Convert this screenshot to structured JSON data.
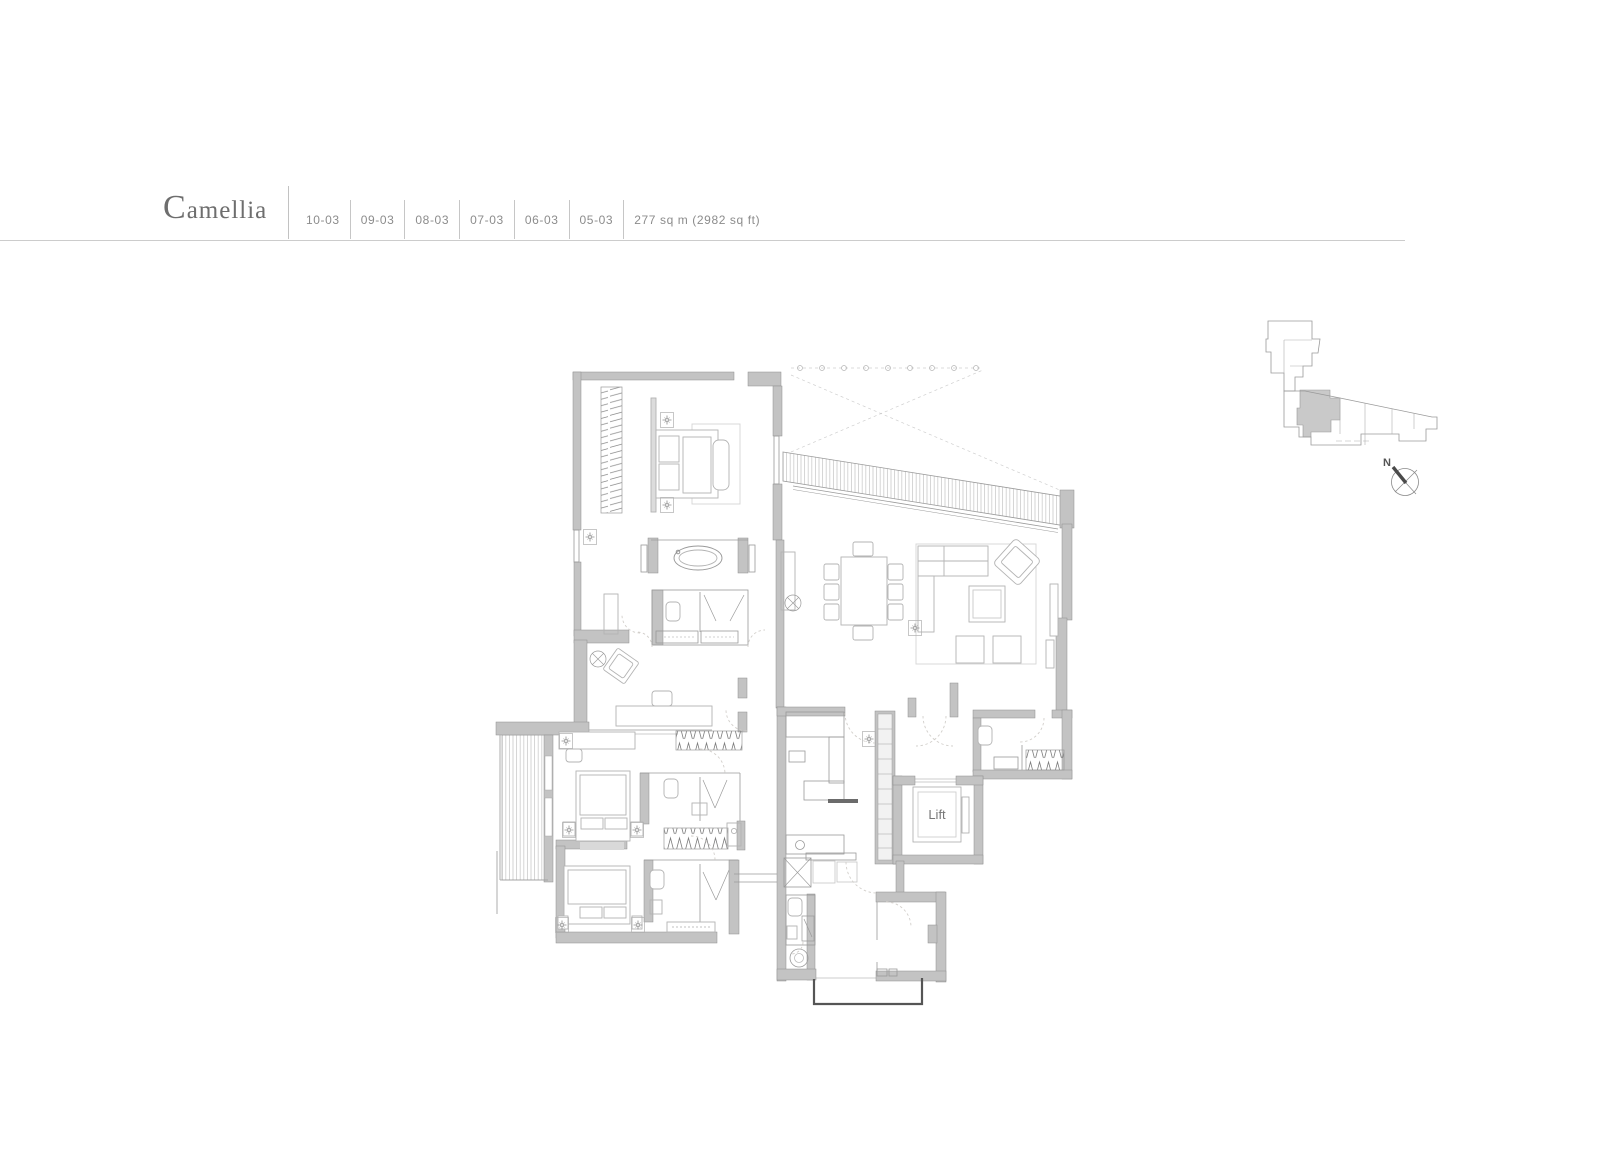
{
  "header": {
    "title": "Camellia",
    "units": [
      "10-03",
      "09-03",
      "08-03",
      "07-03",
      "06-03",
      "05-03"
    ],
    "area": "277 sq m (2982 sq ft)"
  },
  "plan": {
    "lift_label": "Lift"
  },
  "compass": {
    "north_label": "N"
  },
  "colors": {
    "wall": "#c3c3c3",
    "wall_edge": "#8f8f8f",
    "thin_line": "#9a9a9a",
    "furniture": "#b3b3b3",
    "hatch": "#b8b8b8",
    "door_arc": "#d2cfcb",
    "dark_ledge": "#555555",
    "text_gray": "#8c8c8c",
    "unit_highlight": "#c9c9c9"
  }
}
